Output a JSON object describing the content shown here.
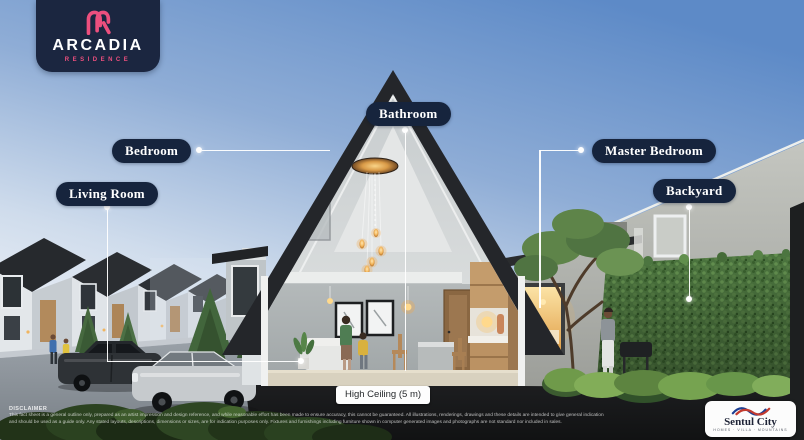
{
  "brand": {
    "monogram": "AR",
    "name": "ARCADIA",
    "subtitle": "RESIDENCE"
  },
  "callouts": {
    "living_room": "Living Room",
    "bedroom": "Bedroom",
    "bathroom": "Bathroom",
    "master_bedroom": "Master Bedroom",
    "backyard": "Backyard"
  },
  "badge": {
    "high_ceiling": "High Ceiling (5 m)"
  },
  "footer": {
    "disclaimer_title": "DISCLAIMER",
    "disclaimer_text": "This fact sheet is a general outline only, prepared as an artist impression and design reference, and while reasonable effort has been made to ensure accuracy, this cannot be guaranteed. All illustrations, renderings, drawings and these details are intended to give general indication and should be used as a guide only. Any stated layouts, descriptions, dimensions or sizes, are for indication purposes only. Fixtures and furnishings including furniture shown in computer generated images and photographs are not standard nor included in sales."
  },
  "developer": {
    "name": "Sentul City",
    "tagline": "HOMES · VILLA · MOUNTAINS"
  },
  "colors": {
    "label_navy": "#16243d",
    "brand_pink": "#ed4f7e",
    "roof_dark": "#24262a",
    "sky_top": "#5d8ac7",
    "hedge_green": "#4d7540",
    "warm_glow": "#f2b45a"
  }
}
